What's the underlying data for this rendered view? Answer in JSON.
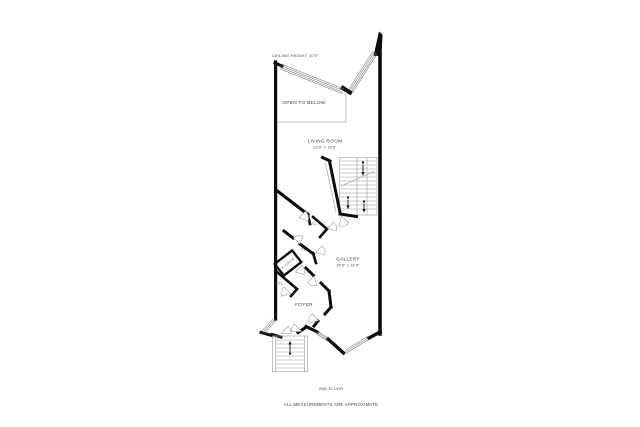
{
  "plan": {
    "ceiling_note": "CEILING HEIGHT: 10'0\"",
    "floor_label": "2ND FLOOR",
    "disclaimer": "ALL MEASUREMENTS ARE APPROXIMATE",
    "closet_label": "CL.",
    "rooms": [
      {
        "name": "OPEN TO BELOW",
        "dims": ""
      },
      {
        "name": "LIVING ROOM",
        "dims": "32'8\" x 19'6\""
      },
      {
        "name": "GALLERY",
        "dims": "25'6\" x 14'4\""
      },
      {
        "name": "FOYER",
        "dims": ""
      },
      {
        "name": "ELEVATOR",
        "dims": ""
      }
    ],
    "colors": {
      "wall": "#0d0d0d",
      "thin_line": "#a9a9a9",
      "text": "#404040",
      "background": "#ffffff"
    }
  }
}
